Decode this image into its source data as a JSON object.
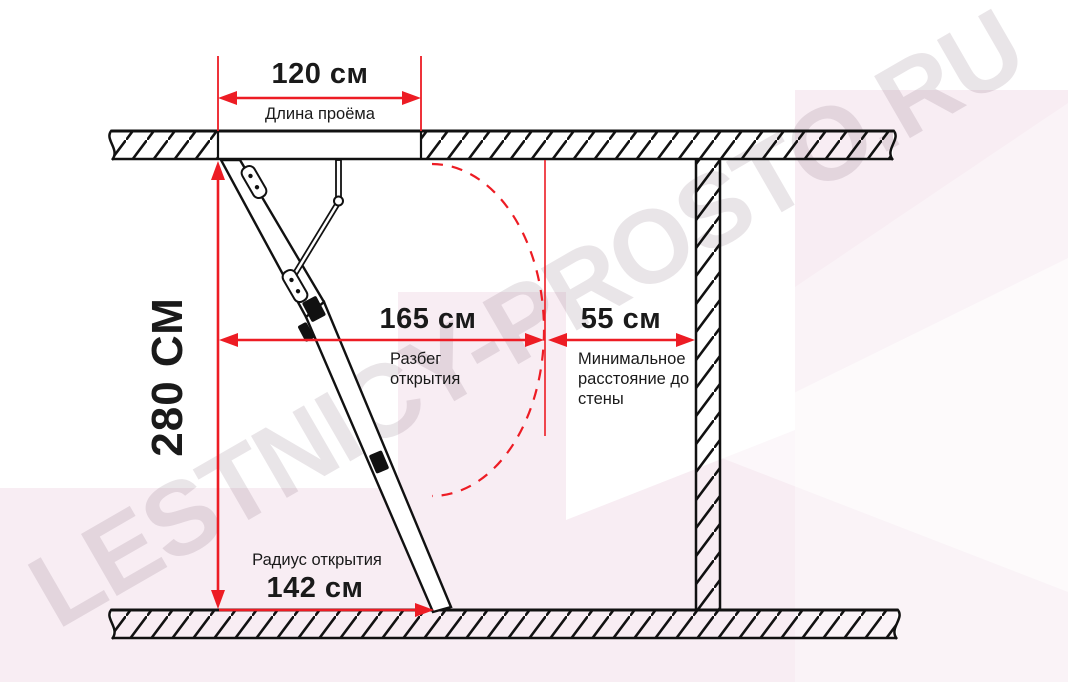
{
  "watermark": {
    "text": "LESTNICY-PROSTO.RU"
  },
  "colors": {
    "accent_red": "#ed1c24",
    "ink": "#1a1a1a",
    "background_pink": "#f8edf3"
  },
  "dimensions": {
    "opening": {
      "value": "120 см",
      "label": "Длина проёма"
    },
    "ceiling_height": {
      "value": "280 СМ"
    },
    "opening_spread": {
      "value": "165 см",
      "label": "Разбег открытия"
    },
    "wall_distance": {
      "value": "55 см",
      "label": "Минимальное расстояние до стены"
    },
    "opening_radius": {
      "value": "142 см",
      "label": "Радиус открытия"
    }
  }
}
